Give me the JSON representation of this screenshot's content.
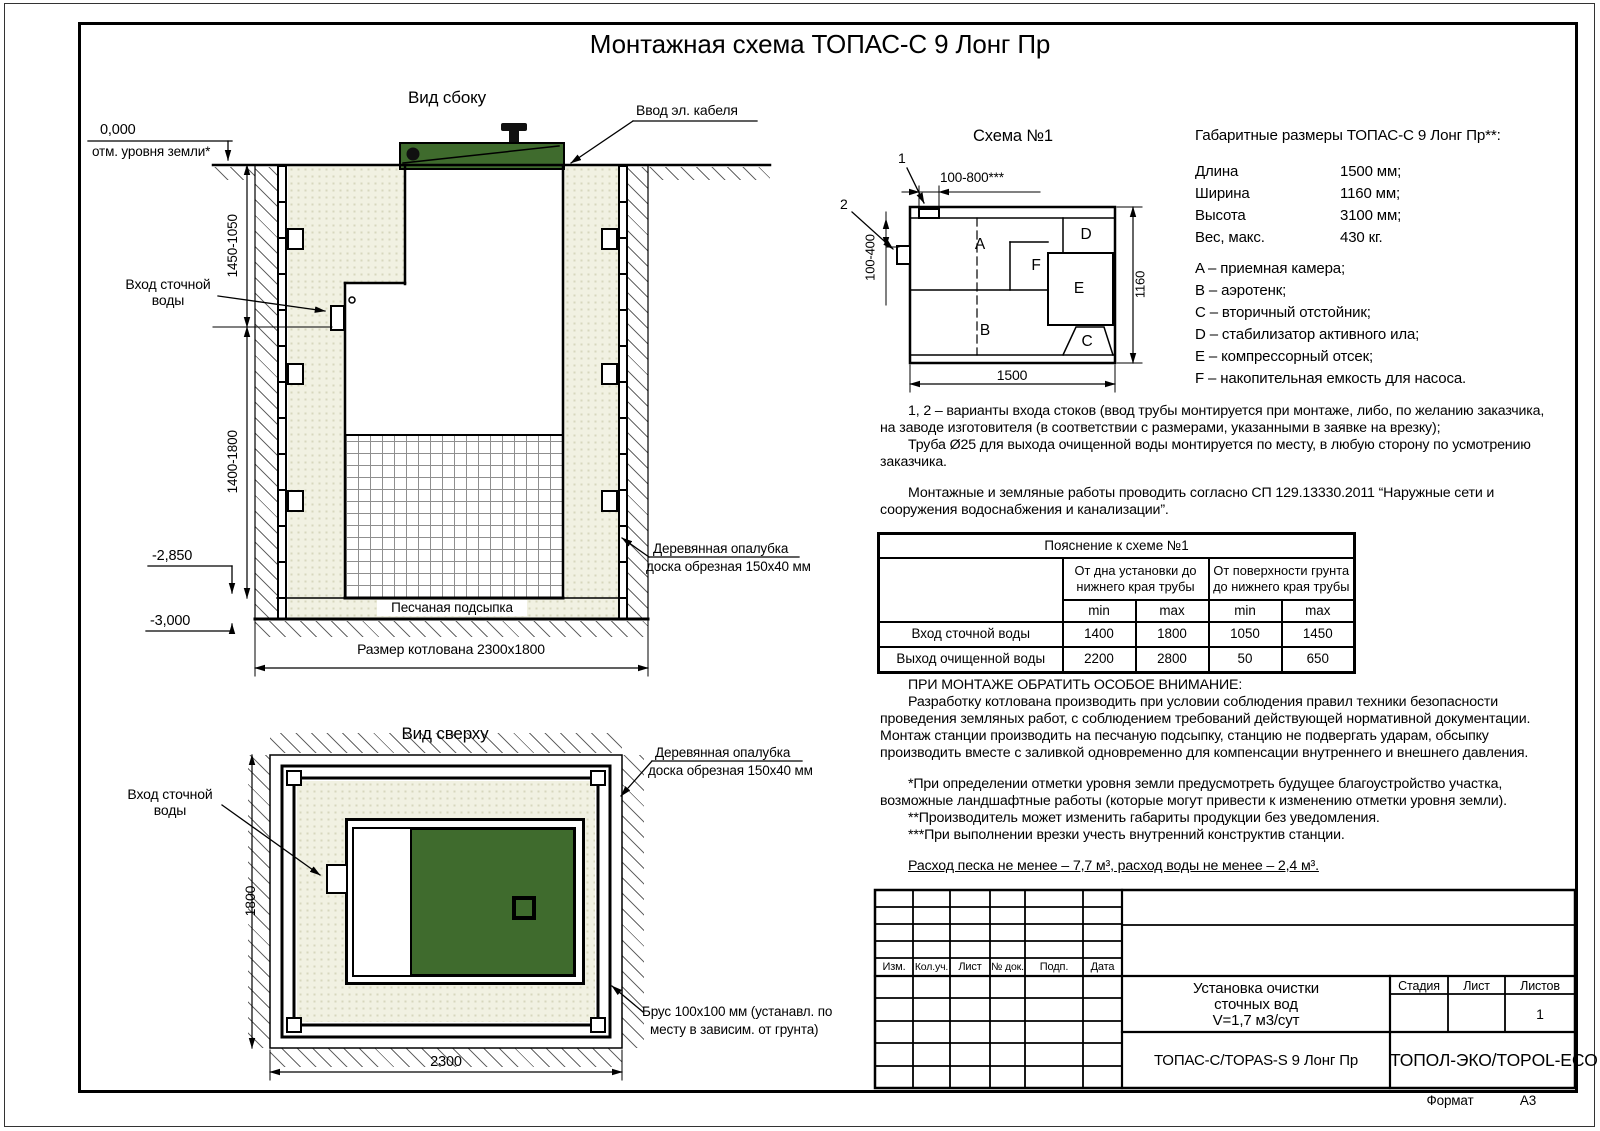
{
  "title": "Монтажная схема ТОПАС-С 9 Лонг Пр",
  "views": {
    "side": "Вид сбоку",
    "top": "Вид сверху"
  },
  "labels": {
    "cable": "Ввод эл. кабеля",
    "inlet_l1": "Вход сточной",
    "inlet_l2": "воды",
    "formwork_l1": "Деревянная опалубка",
    "formwork_l2": "доска обрезная 150x40 мм",
    "beam_l1": "Брус 100x100 мм (устанавл. по",
    "beam_l2": "месту в зависим. от грунта)",
    "sand_bed": "Песчаная подсыпка"
  },
  "levels": {
    "zero": "0,000",
    "zero_note": "отм. уровня земли*",
    "sand": "-2,850",
    "bottom": "-3,000"
  },
  "dims": {
    "side_upper": "1450-1050",
    "side_lower": "1400-1800",
    "pit": "Размер котлована 2300x1800",
    "top_width": "2300",
    "top_height": "1800"
  },
  "schema": {
    "title": "Схема №1",
    "callout_1": "1",
    "callout_2": "2",
    "compartments": [
      "A",
      "B",
      "C",
      "D",
      "E",
      "F"
    ],
    "dims": {
      "top": "100-800***",
      "left": "100-400",
      "bottom": "1500",
      "right": "1160"
    }
  },
  "specs": {
    "heading": "Габаритные размеры ТОПАС-С 9 Лонг Пр**:",
    "rows": [
      {
        "label": "Длина",
        "value": "1500 мм;"
      },
      {
        "label": "Ширина",
        "value": "1160 мм;"
      },
      {
        "label": "Высота",
        "value": "3100 мм;"
      },
      {
        "label": "Вес, макс.",
        "value": "430 кг."
      }
    ],
    "legend": [
      "A – приемная камера;",
      "B – аэротенк;",
      "C – вторичный отстойник;",
      "D – стабилизатор активного ила;",
      "E – компрессорный отсек;",
      "F – накопительная емкость для насоса."
    ]
  },
  "notes": {
    "p1": "1, 2 – варианты входа стоков (ввод трубы монтируется при монтаже, либо, по желанию заказчика, на заводе изготовителя (в соответствии с размерами, указанными в заявке на врезку);",
    "p2": "Труба Ø25 для выхода очищенной воды монтируется по месту, в любую сторону по усмотрению заказчика.",
    "p3": "Монтажные и земляные работы проводить согласно СП 129.13330.2011 “Наружные сети и сооружения водоснабжения и канализации”."
  },
  "table": {
    "title": "Пояснение к схеме №1",
    "group1": "От дна установки до нижнего края трубы",
    "group2": "От поверхности грунта до нижнего края трубы",
    "sub": [
      "min",
      "max",
      "min",
      "max"
    ],
    "rows": [
      {
        "label": "Вход сточной воды",
        "v1": "1400",
        "v2": "1800",
        "v3": "1050",
        "v4": "1450"
      },
      {
        "label": "Выход очищенной воды",
        "v1": "2200",
        "v2": "2800",
        "v3": "50",
        "v4": "650"
      }
    ]
  },
  "attention": {
    "heading": "ПРИ МОНТАЖЕ ОБРАТИТЬ ОСОБОЕ ВНИМАНИЕ:",
    "body": "Разработку котлована производить при условии соблюдения правил техники безопасности проведения земляных работ, с соблюдением требований действующей нормативной документации. Монтаж станции производить на песчаную подсыпку, станцию не подвергать ударам, обсыпку производить вместе с заливкой одновременно для компенсации внутреннего и внешнего давления.",
    "fn1": "*При определении отметки уровня земли предусмотреть будущее благоустройство участка, возможные ландшафтные работы (которые могут привести к изменению отметки уровня земли).",
    "fn2": "**Производитель может изменить габариты продукции без уведомления.",
    "fn3": "***При выполнении врезки учесть внутренний конструктив станции.",
    "consumption": "Расход песка не менее – 7,7 м³, расход воды не менее – 2,4 м³."
  },
  "titleblock": {
    "rev_headers": [
      "Изм.",
      "Кол.уч.",
      "Лист",
      "№ док.",
      "Подп.",
      "Дата"
    ],
    "name_l1": "Установка очистки",
    "name_l2": "сточных вод",
    "name_l3": "V=1,7 м3/сут",
    "stage": "Стадия",
    "sheet": "Лист",
    "sheets": "Листов",
    "sheets_value": "1",
    "model": "ТОПАС-С/TOPAS-S 9 Лонг Пр",
    "company": "ТОПОЛ-ЭКО/TOPOL-ECO",
    "format_label": "Формат",
    "format_value": "А3"
  },
  "colors": {
    "lid_green": "#3f6b2d",
    "sand": "#f1f1e2"
  }
}
